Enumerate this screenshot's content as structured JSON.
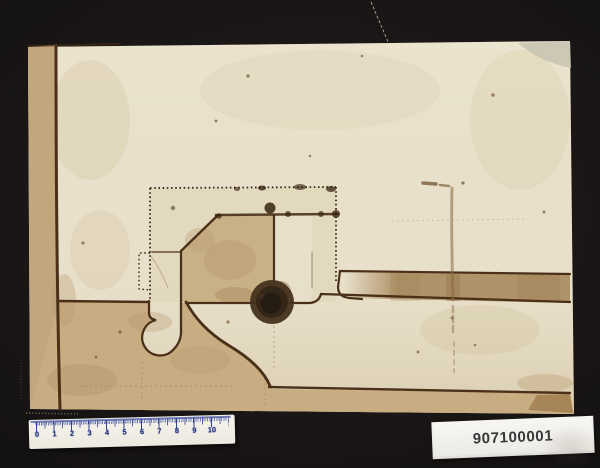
{
  "mount": {
    "background_color": "#1a1616"
  },
  "sheet": {
    "paper_color": "#e8e0ca",
    "edge_strip_color": "#c3a67c",
    "wash_color": "#c9ad82",
    "band_color": "#ab8c61",
    "ink_color": "#4a3018",
    "seal_center_color": "#241b12"
  },
  "ruler": {
    "numbers": [
      "0",
      "1",
      "2",
      "3",
      "4",
      "5",
      "6",
      "7",
      "8",
      "9",
      "10"
    ],
    "accent_color": "#203182"
  },
  "id_label": {
    "text": "907100001",
    "text_color": "#38383a"
  }
}
